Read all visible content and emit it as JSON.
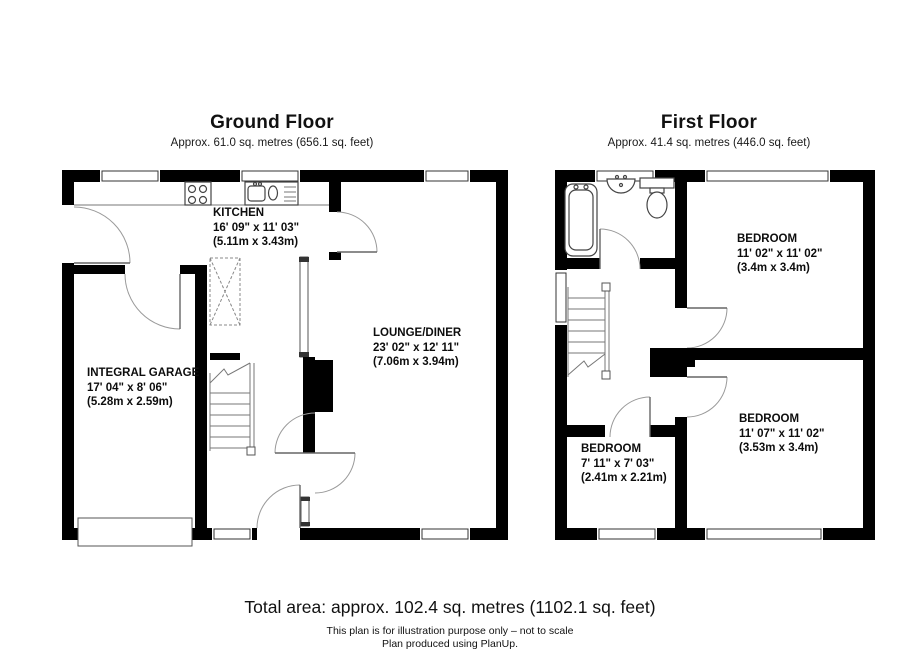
{
  "page": {
    "background": "#ffffff",
    "wall_color": "#000000",
    "line_color": "#777777"
  },
  "floors": [
    {
      "name": "Ground Floor",
      "area": "Approx. 61.0 sq. metres (656.1 sq. feet)",
      "rooms": [
        {
          "name": "KITCHEN",
          "imperial": "16' 09\" x 11' 03\"",
          "metric": "(5.11m x 3.43m)"
        },
        {
          "name": "LOUNGE/DINER",
          "imperial": "23' 02\" x 12' 11\"",
          "metric": "(7.06m x 3.94m)"
        },
        {
          "name": "INTEGRAL GARAGE",
          "imperial": "17' 04\" x 8' 06\"",
          "metric": "(5.28m x 2.59m)"
        }
      ],
      "fixtures": [
        "hob",
        "sink-drainer",
        "stairs",
        "garage-door",
        "front-door"
      ]
    },
    {
      "name": "First Floor",
      "area": "Approx. 41.4 sq. metres (446.0 sq. feet)",
      "rooms": [
        {
          "name": "BEDROOM",
          "imperial": "11' 02\" x 11' 02\"",
          "metric": "(3.4m x 3.4m)"
        },
        {
          "name": "BEDROOM",
          "imperial": "11' 07\" x 11' 02\"",
          "metric": "(3.53m x 3.4m)"
        },
        {
          "name": "BEDROOM",
          "imperial": "7' 11\" x 7' 03\"",
          "metric": "(2.41m x 2.21m)"
        }
      ],
      "fixtures": [
        "bath",
        "basin",
        "toilet",
        "stairs"
      ]
    }
  ],
  "footer": {
    "total": "Total area: approx. 102.4 sq. metres (1102.1 sq. feet)",
    "disclaimer": "This plan is for illustration purpose only – not to scale",
    "credit": "Plan produced using PlanUp."
  }
}
